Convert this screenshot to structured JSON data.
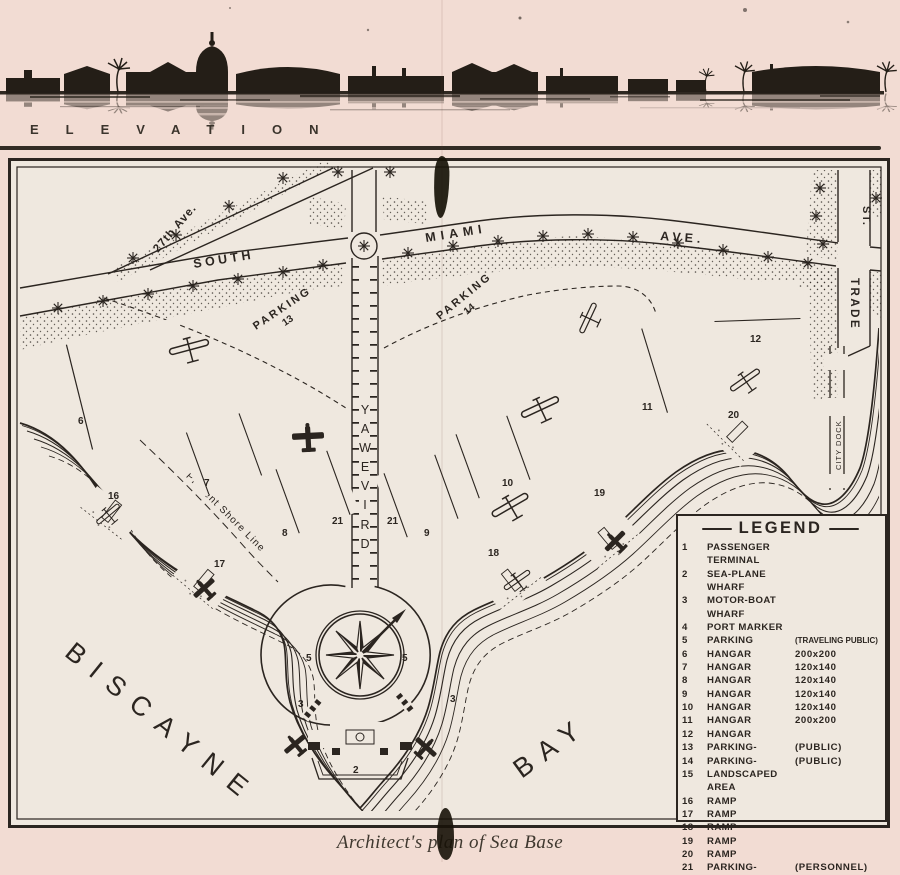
{
  "colors": {
    "page_paper": "#f2dcd3",
    "plan_paper": "#efe8df",
    "ink": "#2b2520"
  },
  "elevation": {
    "label": "ELEVATION"
  },
  "caption": "Architect's plan of Sea Base",
  "plan": {
    "streets": {
      "ave27": "27th Ave.",
      "south": "SOUTH",
      "miami": "MIAMI",
      "ave": "AVE.",
      "trade": "TRADE",
      "st": "ST.",
      "driveway": "DRIVEWAY",
      "city_dock": "CITY DOCK"
    },
    "labels": {
      "parking": "PARKING",
      "parking13_num": "13",
      "parking14_num": "14",
      "biscayne": "BISCAYNE",
      "bay": "BAY",
      "shore_line": "Present Shore Line"
    },
    "numbers": {
      "h6": "6",
      "h7": "7",
      "h8": "8",
      "h9": "9",
      "h10": "10",
      "h11": "11",
      "h12": "12",
      "r16": "16",
      "r17": "17",
      "r18": "18",
      "r19": "19",
      "r20": "20",
      "p21a": "21",
      "p21b": "21",
      "p5a": "5",
      "p5b": "5",
      "w3a": "3",
      "w3b": "3",
      "w2": "2"
    }
  },
  "legend": {
    "title": "LEGEND",
    "items": [
      {
        "num": "1",
        "label": "PASSENGER TERMINAL"
      },
      {
        "num": "2",
        "label": "SEA-PLANE WHARF"
      },
      {
        "num": "3",
        "label": "MOTOR-BOAT WHARF"
      },
      {
        "num": "4",
        "label": "PORT MARKER"
      },
      {
        "num": "5",
        "label": "PARKING",
        "detail": "(TRAVELING PUBLIC)"
      },
      {
        "num": "6",
        "label": "HANGAR",
        "detail": "200x200"
      },
      {
        "num": "7",
        "label": "HANGAR",
        "detail": "120x140"
      },
      {
        "num": "8",
        "label": "HANGAR",
        "detail": "120x140"
      },
      {
        "num": "9",
        "label": "HANGAR",
        "detail": "120x140"
      },
      {
        "num": "10",
        "label": "HANGAR",
        "detail": "120x140"
      },
      {
        "num": "11",
        "label": "HANGAR",
        "detail": "200x200"
      },
      {
        "num": "12",
        "label": "HANGAR"
      },
      {
        "num": "13",
        "label": "PARKING-",
        "detail": "(PUBLIC)"
      },
      {
        "num": "14",
        "label": "PARKING-",
        "detail": "(PUBLIC)"
      },
      {
        "num": "15",
        "label": "LANDSCAPED AREA"
      },
      {
        "num": "16",
        "label": "RAMP"
      },
      {
        "num": "17",
        "label": "RAMP"
      },
      {
        "num": "18",
        "label": "RAMP"
      },
      {
        "num": "19",
        "label": "RAMP"
      },
      {
        "num": "20",
        "label": "RAMP"
      },
      {
        "num": "21",
        "label": "PARKING-",
        "detail": "(PERSONNEL)"
      }
    ]
  }
}
